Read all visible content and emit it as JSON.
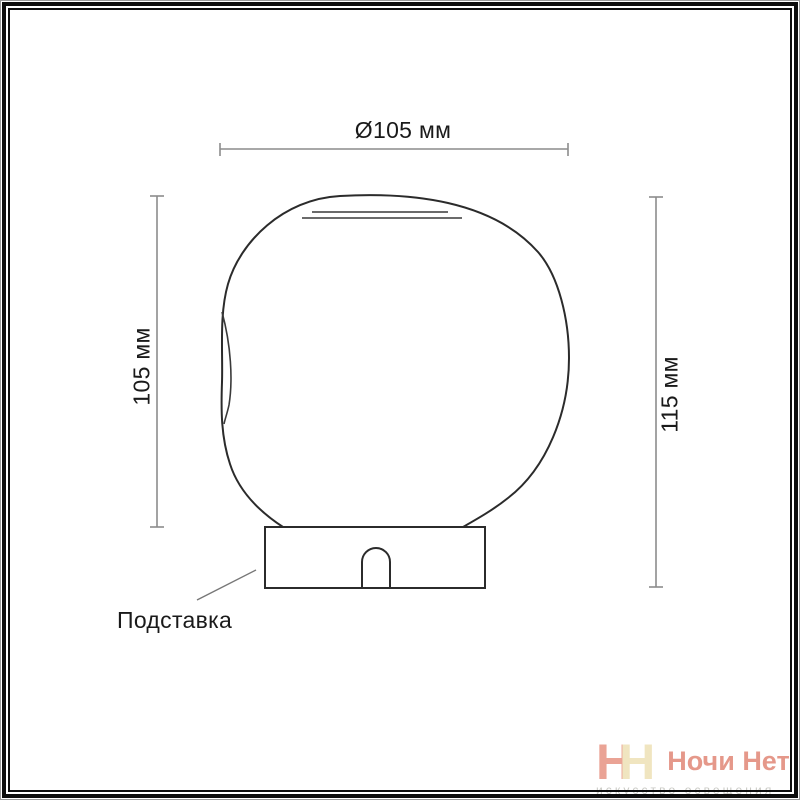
{
  "page": {
    "background": "#ffffff",
    "frame_color": "#0d0d0d",
    "line_color": "#2b2b2b",
    "dimension_line_color": "#8c8c8c",
    "text_color": "#1a1a1a"
  },
  "diagram": {
    "type": "product-dimension-drawing",
    "subject": "table lamp: irregular round glass shade on rectangular stand with cord notch",
    "labels": {
      "diameter": "Ø105 мм",
      "shade_height": "105 мм",
      "total_height": "115 мм",
      "base": "Подставка"
    },
    "dimensions_mm": {
      "diameter": 105,
      "shade_height": 105,
      "total_height": 115
    }
  },
  "watermark": {
    "monogram_left_letter": "Н",
    "monogram_right_letter": "Н",
    "brand": "Ночи Нет",
    "tagline": "искусство освещения",
    "colors": {
      "monogram_left": "#eaa395",
      "monogram_right": "#f0e5c0",
      "brand": "#e5988a",
      "tagline": "#c9c9c4"
    }
  }
}
